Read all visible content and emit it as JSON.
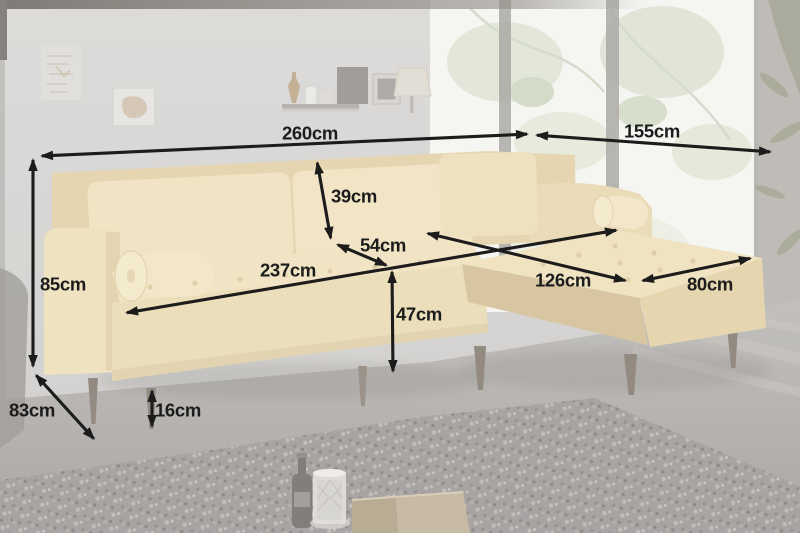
{
  "diagram": {
    "unit": "cm",
    "dimensions": [
      {
        "id": "total-width",
        "value": 260,
        "label": "260cm",
        "x1": 40,
        "y1": 156,
        "x2": 529,
        "y2": 134,
        "lx": 310,
        "ly": 133
      },
      {
        "id": "corner-width",
        "value": 155,
        "label": "155cm",
        "x1": 535,
        "y1": 135,
        "x2": 772,
        "y2": 152,
        "lx": 652,
        "ly": 131
      },
      {
        "id": "overall-height",
        "value": 85,
        "label": "85cm",
        "x1": 33,
        "y1": 158,
        "x2": 33,
        "y2": 368,
        "lx": 63,
        "ly": 284
      },
      {
        "id": "backrest-height",
        "value": 39,
        "label": "39cm",
        "x1": 317,
        "y1": 161,
        "x2": 331,
        "y2": 240,
        "lx": 354,
        "ly": 196
      },
      {
        "id": "backrest-depth",
        "value": 54,
        "label": "54cm",
        "x1": 336,
        "y1": 244,
        "x2": 388,
        "y2": 266,
        "lx": 383,
        "ly": 245
      },
      {
        "id": "seat-width",
        "value": 237,
        "label": "237cm",
        "x1": 125,
        "y1": 313,
        "x2": 618,
        "y2": 230,
        "lx": 288,
        "ly": 270
      },
      {
        "id": "chaise-length",
        "value": 126,
        "label": "126cm",
        "x1": 426,
        "y1": 233,
        "x2": 627,
        "y2": 281,
        "lx": 563,
        "ly": 280
      },
      {
        "id": "chaise-width",
        "value": 80,
        "label": "80cm",
        "x1": 641,
        "y1": 281,
        "x2": 752,
        "y2": 258,
        "lx": 710,
        "ly": 284
      },
      {
        "id": "seat-height",
        "value": 47,
        "label": "47cm",
        "x1": 392,
        "y1": 270,
        "x2": 393,
        "y2": 373,
        "lx": 419,
        "ly": 314
      },
      {
        "id": "depth",
        "value": 83,
        "label": "83cm",
        "x1": 35,
        "y1": 374,
        "x2": 95,
        "y2": 440,
        "lx": 32,
        "ly": 410
      },
      {
        "id": "leg-height",
        "value": 16,
        "label": "16cm",
        "x1": 152,
        "y1": 389,
        "x2": 152,
        "y2": 428,
        "lx": 178,
        "ly": 410
      }
    ]
  },
  "colors": {
    "dimension_line": "#1c1c1c",
    "dimension_label": "#1c1c1c",
    "sofa_fabric_washed": "#e7d6a8",
    "wall": "#c9c7c4",
    "window": "#f2f3ee",
    "floor": "#9b9793",
    "rug": "#878280"
  }
}
